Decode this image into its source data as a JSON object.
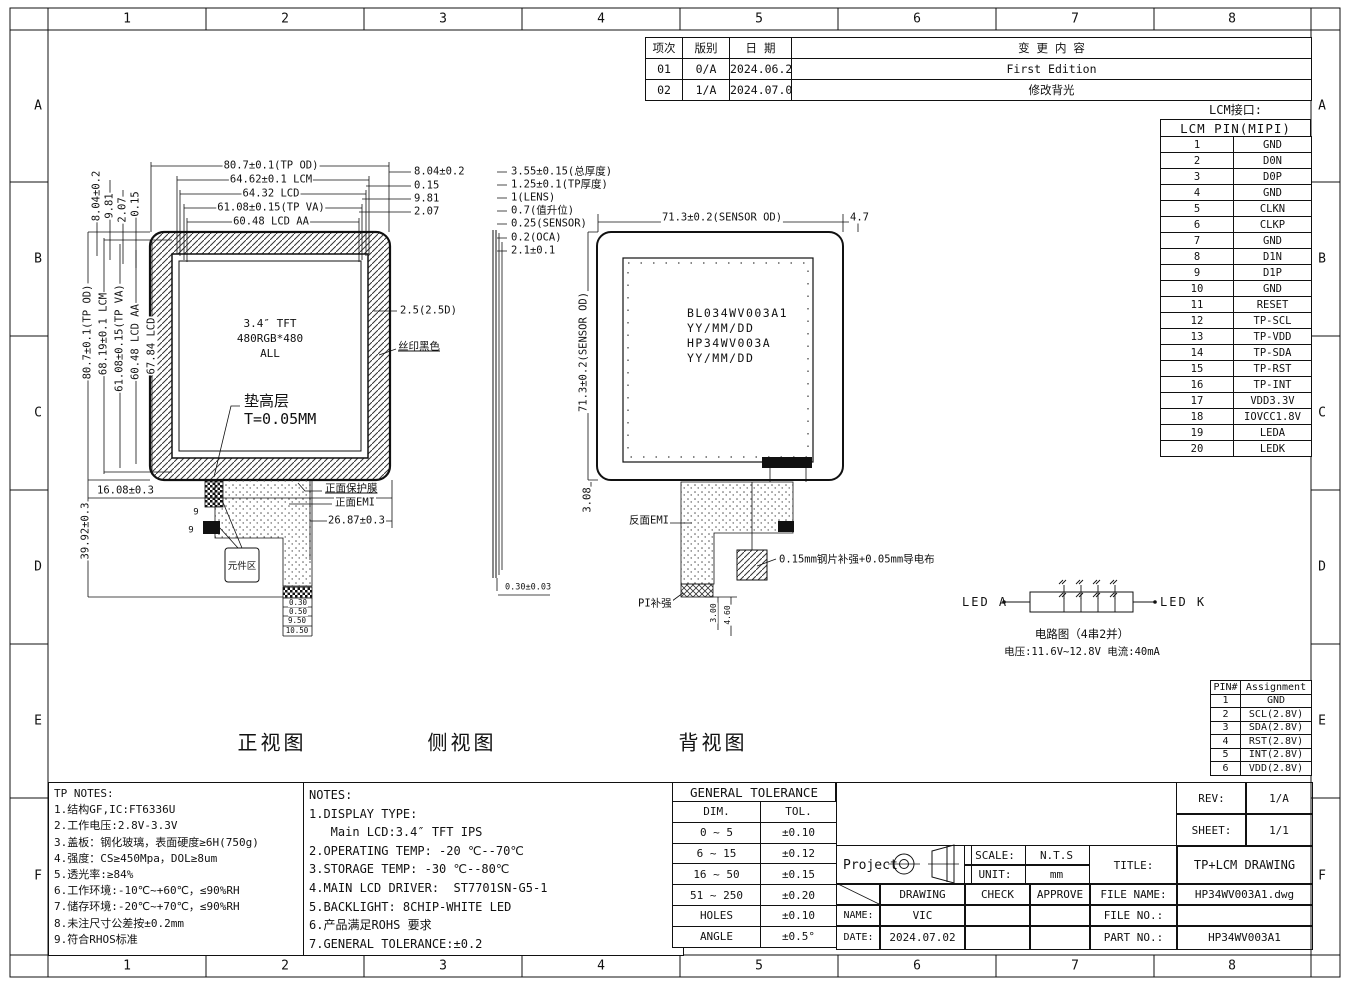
{
  "frame": {
    "cols": [
      "1",
      "2",
      "3",
      "4",
      "5",
      "6",
      "7",
      "8"
    ],
    "rows": [
      "A",
      "B",
      "C",
      "D",
      "E",
      "F"
    ]
  },
  "revision_table": {
    "head": [
      [
        "项次",
        "版别",
        "日 期",
        "变 更 内 容"
      ]
    ],
    "rows": [
      [
        "01",
        "0/A",
        "2024.06.25",
        "First Edition"
      ],
      [
        "02",
        "1/A",
        "2024.07.02",
        "修改背光"
      ]
    ]
  },
  "lcm_interface": {
    "label": "LCM接口:",
    "title": "LCM PIN(MIPI)",
    "rows": [
      [
        "1",
        "GND"
      ],
      [
        "2",
        "D0N"
      ],
      [
        "3",
        "D0P"
      ],
      [
        "4",
        "GND"
      ],
      [
        "5",
        "CLKN"
      ],
      [
        "6",
        "CLKP"
      ],
      [
        "7",
        "GND"
      ],
      [
        "8",
        "D1N"
      ],
      [
        "9",
        "D1P"
      ],
      [
        "10",
        "GND"
      ],
      [
        "11",
        "RESET"
      ],
      [
        "12",
        "TP-SCL"
      ],
      [
        "13",
        "TP-VDD"
      ],
      [
        "14",
        "TP-SDA"
      ],
      [
        "15",
        "TP-RST"
      ],
      [
        "16",
        "TP-INT"
      ],
      [
        "17",
        "VDD3.3V"
      ],
      [
        "18",
        "IOVCC1.8V"
      ],
      [
        "19",
        "LEDA"
      ],
      [
        "20",
        "LEDK"
      ]
    ]
  },
  "pin_assignment": {
    "head": [
      [
        "PIN#",
        "Assignment"
      ]
    ],
    "rows": [
      [
        "1",
        "GND"
      ],
      [
        "2",
        "SCL(2.8V)"
      ],
      [
        "3",
        "SDA(2.8V)"
      ],
      [
        "4",
        "RST(2.8V)"
      ],
      [
        "5",
        "INT(2.8V)"
      ],
      [
        "6",
        "VDD(2.8V)"
      ]
    ]
  },
  "views": {
    "front": "正视图",
    "side": "侧视图",
    "back": "背视图"
  },
  "front_view": {
    "center_text": [
      "3.4″ TFT",
      "480RGB*480",
      "ALL"
    ],
    "component_label": "元件区"
  },
  "back_view": {
    "center_text": [
      "BL034WV003A1",
      "YY/MM/DD",
      "HP34WV003A",
      "YY/MM/DD"
    ]
  },
  "led_circuit": {
    "left": "LED A",
    "right": "LED K",
    "caption1": "电路图（4串2并）",
    "caption2": "电压:11.6V~12.8V  电流:40mA"
  },
  "tp_notes": {
    "title": "TP NOTES:",
    "items": [
      "1.结构GF,IC:FT6336U",
      "2.工作电压:2.8V-3.3V",
      "3.盖板：钢化玻璃，表面硬度≥6H(750g)",
      "4.强度：CS≥450Mpa，DOL≥8um",
      "5.透光率:≥84%",
      "6.工作环境:-10℃~+60℃，≤90%RH",
      "7.储存环境:-20℃~+70℃，≤90%RH",
      "8.未注尺寸公差按±0.2mm",
      "9.符合RHOS标准"
    ]
  },
  "notes": {
    "title": "NOTES:",
    "items": [
      "1.DISPLAY TYPE:",
      "   Main LCD:3.4″ TFT IPS",
      "2.OPERATING TEMP: -20 ℃--70℃",
      "3.STORAGE TEMP: -30 ℃--80℃",
      "4.MAIN LCD DRIVER:  ST7701SN-G5-1",
      "5.BACKLIGHT: 8CHIP-WHITE LED",
      "6.产品满足ROHS 要求",
      "7.GENERAL TOLERANCE:±0.2"
    ]
  },
  "tolerance_table": {
    "title": "GENERAL TOLERANCE",
    "head": [
      [
        "DIM.",
        "TOL."
      ]
    ],
    "rows": [
      [
        "0 ~ 5",
        "±0.10"
      ],
      [
        "6 ~ 15",
        "±0.12"
      ],
      [
        "16 ~ 50",
        "±0.15"
      ],
      [
        "51 ~ 250",
        "±0.20"
      ],
      [
        "HOLES",
        "±0.10"
      ],
      [
        "ANGLE",
        "±0.5°"
      ]
    ]
  },
  "title_block": {
    "rev_label": "REV:",
    "rev": "1/A",
    "sheet_label": "SHEET:",
    "sheet": "1/1",
    "project_label": "Project",
    "scale_label": "SCALE:",
    "scale": "N.T.S",
    "unit_label": "UNIT:",
    "unit": "mm",
    "title_label": "TITLE:",
    "title": "TP+LCM DRAWING",
    "drawing_label": "DRAWING",
    "check_label": "CHECK",
    "approve_label": "APPROVE",
    "file_name_label": "FILE NAME:",
    "file_name": "HP34WV003A1.dwg",
    "name_label": "NAME:",
    "name": "VIC",
    "file_no_label": "FILE NO.:",
    "file_no": "",
    "date_label": "DATE:",
    "date": "2024.07.02",
    "part_no_label": "PART NO.:",
    "part_no": "HP34WV003A1"
  },
  "colors": {
    "line": "#111111",
    "paper": "#ffffff"
  },
  "dim_labels": [
    {
      "t": "80.7±0.1(TP OD)",
      "x": 271,
      "y": 166
    },
    {
      "t": "64.62±0.1 LCM",
      "x": 271,
      "y": 180
    },
    {
      "t": "64.32 LCD",
      "x": 271,
      "y": 194
    },
    {
      "t": "61.08±0.15(TP VA)",
      "x": 271,
      "y": 208
    },
    {
      "t": "60.48 LCD AA",
      "x": 271,
      "y": 222
    },
    {
      "t": "8.04±0.2",
      "x": 413,
      "y": 172,
      "a": "l"
    },
    {
      "t": "0.15",
      "x": 413,
      "y": 186,
      "a": "l"
    },
    {
      "t": "9.81",
      "x": 413,
      "y": 199,
      "a": "l"
    },
    {
      "t": "2.07",
      "x": 413,
      "y": 212,
      "a": "l"
    },
    {
      "t": "8.04±0.2",
      "x": 97,
      "y": 196,
      "r": 1
    },
    {
      "t": "9.81",
      "x": 110,
      "y": 206,
      "r": 1
    },
    {
      "t": "2.07",
      "x": 123,
      "y": 210,
      "r": 1
    },
    {
      "t": "0.15",
      "x": 136,
      "y": 204,
      "r": 1
    },
    {
      "t": "80.7±0.1(TP OD)",
      "x": 88,
      "y": 332,
      "r": 1
    },
    {
      "t": "68.19±0.1 LCM",
      "x": 104,
      "y": 334,
      "r": 1
    },
    {
      "t": "61.08±0.15(TP VA)",
      "x": 120,
      "y": 338,
      "r": 1
    },
    {
      "t": "60.48 LCD AA",
      "x": 136,
      "y": 342,
      "r": 1
    },
    {
      "t": "67.84 LCD",
      "x": 152,
      "y": 346,
      "r": 1
    },
    {
      "t": "2.5(2.5D)",
      "x": 399,
      "y": 311,
      "a": "l"
    },
    {
      "t": "丝印黑色",
      "x": 397,
      "y": 347,
      "a": "l",
      "u": 1
    },
    {
      "t": "垫高层",
      "x": 243,
      "y": 402,
      "a": "l",
      "s": 15
    },
    {
      "t": "T=0.05MM",
      "x": 243,
      "y": 420,
      "a": "l",
      "s": 15
    },
    {
      "t": "16.08±0.3",
      "x": 96,
      "y": 491,
      "a": "l"
    },
    {
      "t": "39.92±0.3",
      "x": 86,
      "y": 531,
      "r": 1
    },
    {
      "t": "正面保护膜",
      "x": 324,
      "y": 489,
      "a": "l",
      "u": 1
    },
    {
      "t": "正面EMI",
      "x": 334,
      "y": 503,
      "a": "l"
    },
    {
      "t": "26.87±0.3",
      "x": 327,
      "y": 521,
      "a": "l"
    },
    {
      "t": "9",
      "x": 196,
      "y": 513,
      "s": 9
    },
    {
      "t": "9",
      "x": 191,
      "y": 531,
      "s": 9
    },
    {
      "t": "0.30",
      "x": 298,
      "y": 603,
      "s": 7.5
    },
    {
      "t": "0.50",
      "x": 298,
      "y": 612,
      "s": 7.5
    },
    {
      "t": "9.50",
      "x": 297,
      "y": 621,
      "s": 7.5
    },
    {
      "t": "10.50",
      "x": 297,
      "y": 631,
      "s": 7.5
    },
    {
      "t": "3.55±0.15(总厚度)",
      "x": 510,
      "y": 172,
      "a": "l"
    },
    {
      "t": "1.25±0.1(TP厚度)",
      "x": 510,
      "y": 185,
      "a": "l"
    },
    {
      "t": "1(LENS)",
      "x": 510,
      "y": 198,
      "a": "l"
    },
    {
      "t": "0.7(值升位)",
      "x": 510,
      "y": 211,
      "a": "l"
    },
    {
      "t": "0.25(SENSOR)",
      "x": 510,
      "y": 224,
      "a": "l"
    },
    {
      "t": "0.2(OCA)",
      "x": 510,
      "y": 238,
      "a": "l"
    },
    {
      "t": "2.1±0.1",
      "x": 510,
      "y": 251,
      "a": "l"
    },
    {
      "t": "0.30±0.03",
      "x": 504,
      "y": 588,
      "a": "l",
      "s": 8.5
    },
    {
      "t": "71.3±0.2(SENSOR OD)",
      "x": 722,
      "y": 218
    },
    {
      "t": "4.7",
      "x": 849,
      "y": 218,
      "a": "l"
    },
    {
      "t": "71.3±0.2(SENSOR OD)",
      "x": 584,
      "y": 352,
      "r": 1
    },
    {
      "t": "3.08",
      "x": 588,
      "y": 500,
      "r": 1
    },
    {
      "t": "反面EMI",
      "x": 628,
      "y": 521,
      "a": "l"
    },
    {
      "t": "0.15mm钢片补强+0.05mm导电布",
      "x": 778,
      "y": 560,
      "a": "l"
    },
    {
      "t": "PI补强",
      "x": 637,
      "y": 604,
      "a": "l"
    },
    {
      "t": "3.00",
      "x": 714,
      "y": 613,
      "r": 1,
      "s": 8
    },
    {
      "t": "4.60",
      "x": 728,
      "y": 615,
      "r": 1,
      "s": 8
    }
  ]
}
